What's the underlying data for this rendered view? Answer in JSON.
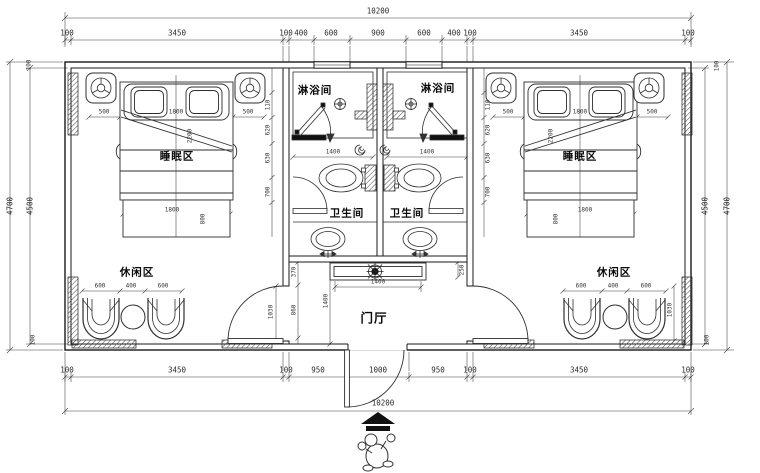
{
  "rooms": {
    "sleeping": "睡眠区",
    "shower": "淋浴间",
    "toilet": "卫生间",
    "leisure": "休闲区",
    "hall": "门厅"
  },
  "dims": {
    "total": "10200",
    "top_chain": [
      "100",
      "3450",
      "100",
      "400",
      "600",
      "900",
      "600",
      "400",
      "100",
      "3450",
      "100"
    ],
    "bottom_chain": [
      "100",
      "3450",
      "100",
      "950",
      "1000",
      "950",
      "100",
      "3450",
      "100"
    ],
    "v_outer": "4700",
    "v_inner": "4500",
    "wall": "100",
    "bed_w": [
      "500",
      "1800",
      "500"
    ],
    "bed_foot": "1800",
    "bed_foot_d": "800",
    "bed_len": "2200",
    "bed_side": [
      "110",
      "620",
      "630",
      "700"
    ],
    "chairs": [
      "600",
      "400",
      "600"
    ],
    "bath_w": "1400",
    "console_w": "1400",
    "hall_d": "1400",
    "hall_side": [
      "370",
      "860"
    ],
    "console_off": "250",
    "door_h": "1030"
  },
  "symbols": {
    "entry_arrow": "entry-direction-arrow",
    "person": "person-figure",
    "fan": "ceiling-fan",
    "drain": "floor-drain",
    "lamp": "bedside-lamp"
  },
  "colors": {
    "line": "#1a1a1a",
    "dim_line": "#3f3f3f",
    "background": "#ffffff"
  }
}
